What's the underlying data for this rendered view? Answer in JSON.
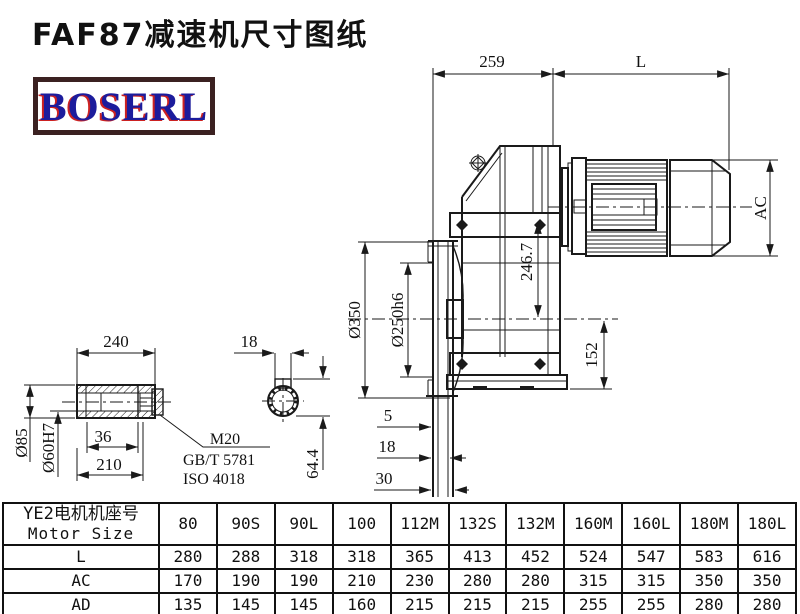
{
  "page": {
    "title": "FAF87减速机尺寸图纸",
    "logo_text": "BOSERL"
  },
  "colors": {
    "line": "#1a1a1a",
    "logo_border": "#3b2121",
    "logo_text": "#1c1c9c",
    "logo_shadow": "#cc2222",
    "background": "#ffffff"
  },
  "drawing": {
    "dims": {
      "d259": "259",
      "dL": "L",
      "dAC": "AC",
      "d350": "Ø350",
      "d250": "Ø250h6",
      "d246": "246.7",
      "d152": "152",
      "g5": "5",
      "g18": "18",
      "g30": "30",
      "s240": "240",
      "s85": "Ø85",
      "s60": "Ø60H7",
      "s36": "36",
      "s210": "210",
      "c18": "18",
      "c644": "64.4"
    },
    "leader": {
      "l1": "M20",
      "l2": "GB/T 5781",
      "l3": "ISO 4018"
    }
  },
  "table": {
    "header_cn": "YE2电机机座号",
    "header_en": "Motor Size",
    "columns": [
      "80",
      "90S",
      "90L",
      "100",
      "112M",
      "132S",
      "132M",
      "160M",
      "160L",
      "180M",
      "180L"
    ],
    "rows": [
      {
        "label": "L",
        "values": [
          "280",
          "288",
          "318",
          "318",
          "365",
          "413",
          "452",
          "524",
          "547",
          "583",
          "616"
        ]
      },
      {
        "label": "AC",
        "values": [
          "170",
          "190",
          "190",
          "210",
          "230",
          "280",
          "280",
          "315",
          "315",
          "350",
          "350"
        ]
      },
      {
        "label": "AD",
        "values": [
          "135",
          "145",
          "145",
          "160",
          "215",
          "215",
          "215",
          "255",
          "255",
          "280",
          "280"
        ]
      }
    ]
  }
}
